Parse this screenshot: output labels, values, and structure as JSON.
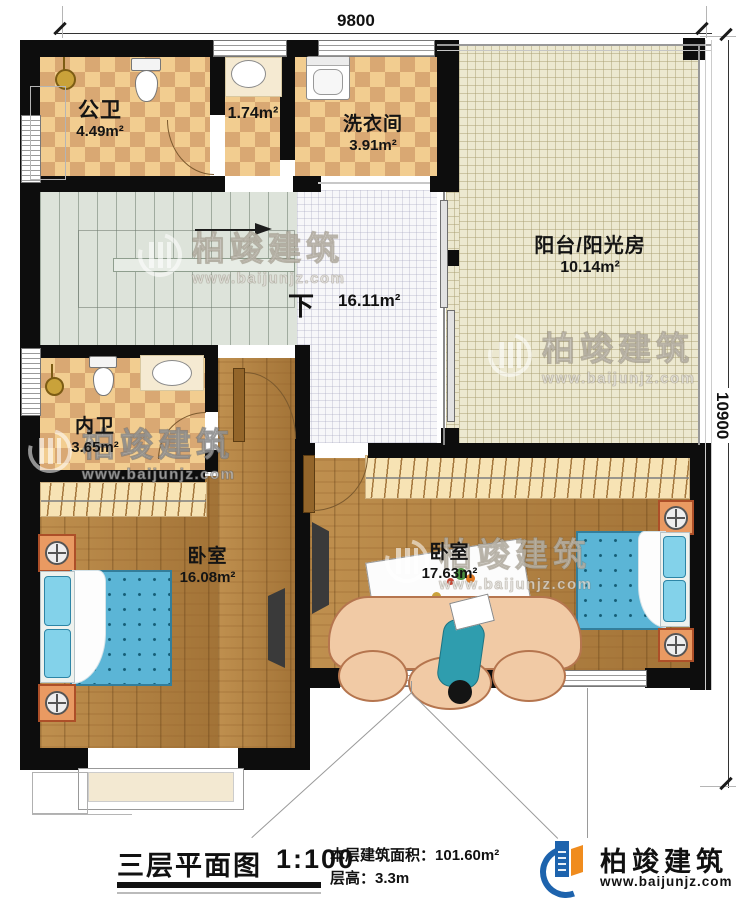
{
  "dimensions": {
    "top": "9800",
    "right": "10900"
  },
  "rooms": {
    "gongwei": {
      "name": "公卫",
      "area": "4.49m²"
    },
    "xiaojian": {
      "area": "1.74m²"
    },
    "xiyijian": {
      "name": "洗衣间",
      "area": "3.91m²"
    },
    "yangtai": {
      "name": "阳台/阳光房",
      "area": "10.14m²"
    },
    "guodao": {
      "area": "16.11m²"
    },
    "neiwei": {
      "name": "内卫",
      "area": "3.65m²"
    },
    "woshi1": {
      "name": "卧室",
      "area": "16.08m²"
    },
    "woshi2": {
      "name": "卧室",
      "area": "17.63m²"
    }
  },
  "stairs": {
    "down": "下"
  },
  "watermark": {
    "brand": "柏竣建筑",
    "site": "www.baijunjz.com"
  },
  "footer": {
    "title": "三层平面图",
    "scale": "1:100",
    "area_label": "本层建筑面积：",
    "area_value": "101.60m²",
    "height_label": "层高：",
    "height_value": "3.3m"
  },
  "brand": {
    "name": "柏竣建筑",
    "site": "www.baijunjz.com"
  }
}
